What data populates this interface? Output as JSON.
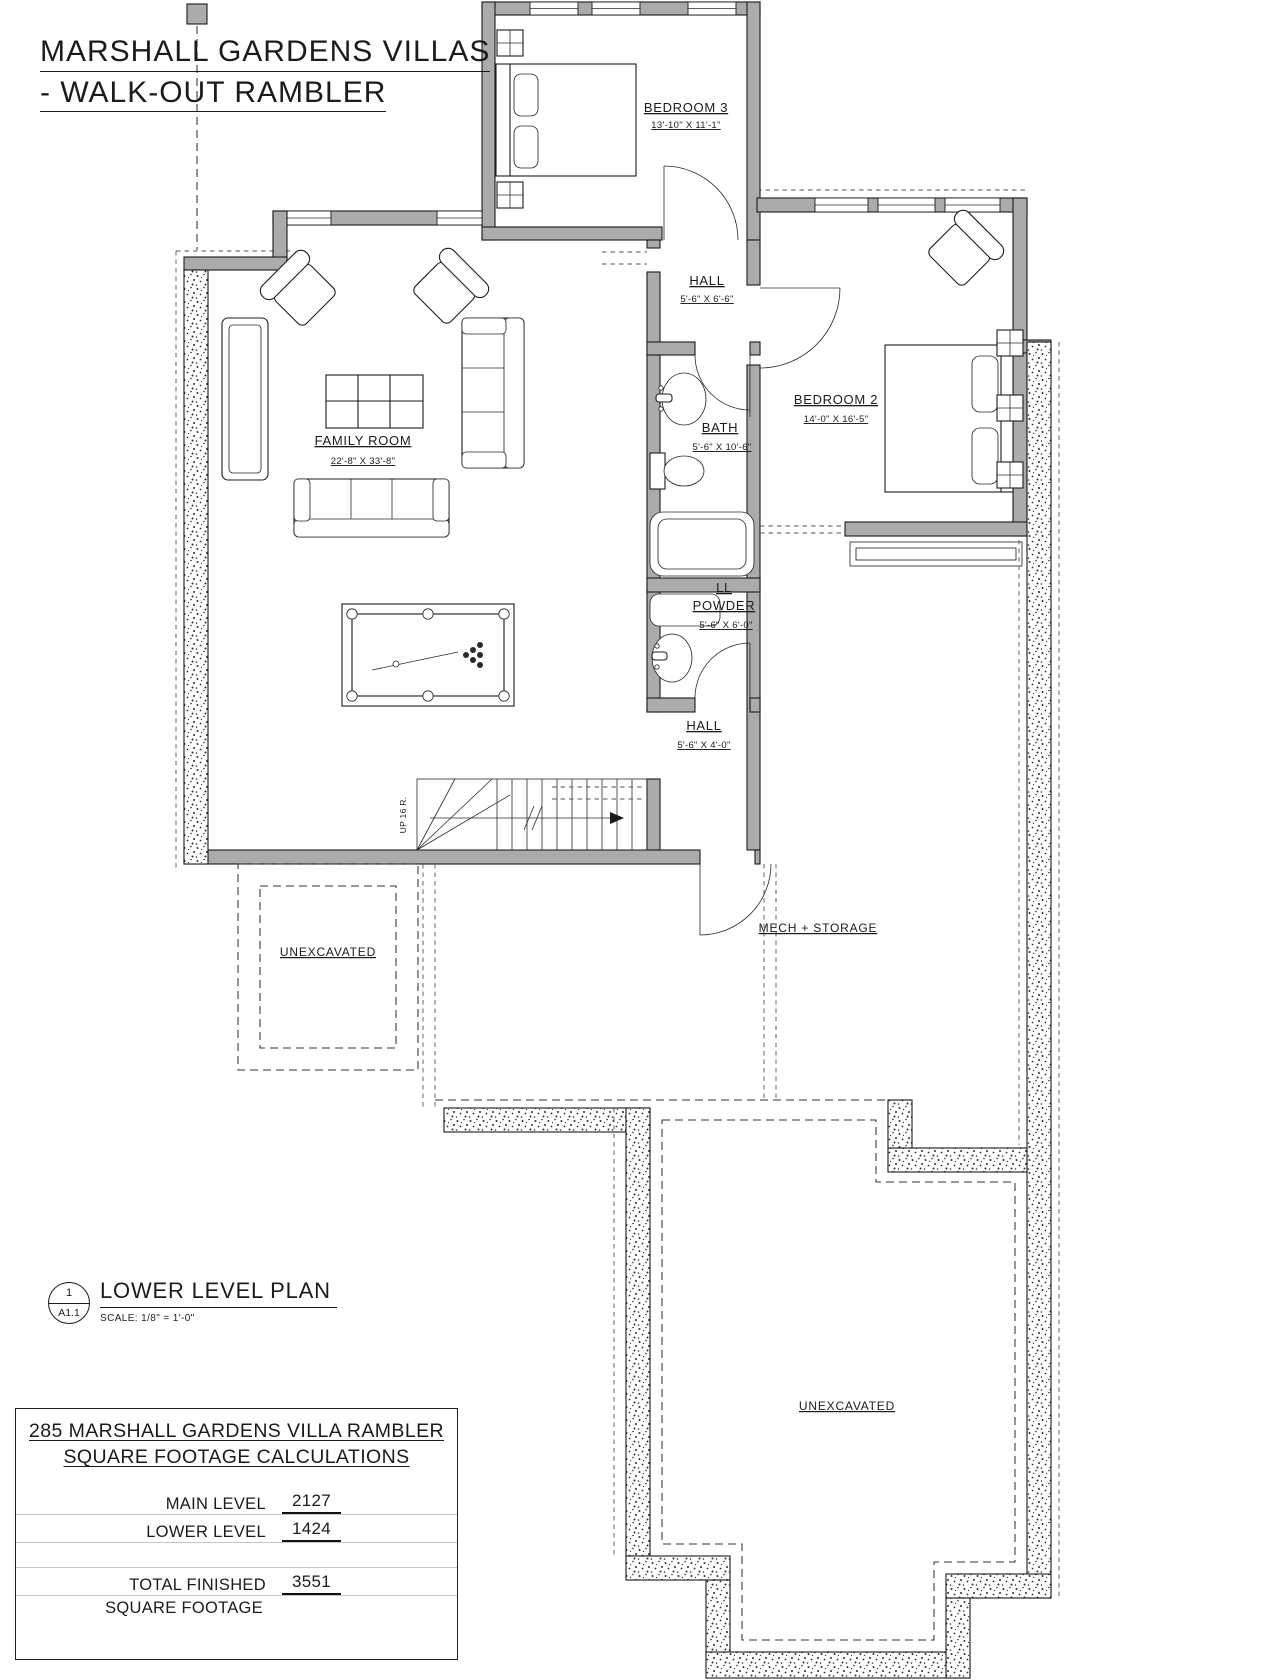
{
  "header": {
    "title_line1": "MARSHALL GARDENS VILLAS",
    "title_line2": "- WALK-OUT RAMBLER"
  },
  "rooms": {
    "bedroom3": {
      "name": "BEDROOM 3",
      "dims": "13'-10\" X 11'-1\""
    },
    "hall_upper": {
      "name": "HALL",
      "dims": "5'-6\" X 6'-6\""
    },
    "bedroom2": {
      "name": "BEDROOM 2",
      "dims": "14'-0\" X 16'-5\""
    },
    "bath": {
      "name": "BATH",
      "dims": "5'-6\" X 10'-6\""
    },
    "family_room": {
      "name": "FAMILY ROOM",
      "dims": "22'-8\" X 33'-8\""
    },
    "ll_powder": {
      "name_line1": "LL",
      "name_line2": "POWDER",
      "dims": "5'-6\" X 6'-0\""
    },
    "hall_lower": {
      "name": "HALL",
      "dims": "5'-6\" X 4'-0\""
    },
    "mech_storage": {
      "name": "MECH + STORAGE"
    },
    "unexcavated_left": {
      "name": "UNEXCAVATED"
    },
    "unexcavated_right": {
      "name": "UNEXCAVATED"
    }
  },
  "stairs": {
    "direction_label": "UP 16 R."
  },
  "plan_title": {
    "detail_number": "1",
    "sheet_number": "A1.1",
    "name": "LOWER LEVEL PLAN",
    "scale": "SCALE:  1/8\" = 1'-0\""
  },
  "sqft_table": {
    "title_line1": "285 MARSHALL GARDENS VILLA RAMBLER",
    "title_line2": "SQUARE FOOTAGE CALCULATIONS",
    "rows": [
      {
        "label": "MAIN LEVEL",
        "value": "2127"
      },
      {
        "label": "LOWER LEVEL",
        "value": "1424"
      },
      {
        "label": "TOTAL FINISHED",
        "label_line2": "SQUARE FOOTAGE",
        "value": "3551"
      }
    ]
  },
  "colors": {
    "wall_fill": "#ababab",
    "line": "#1a1a1a"
  }
}
